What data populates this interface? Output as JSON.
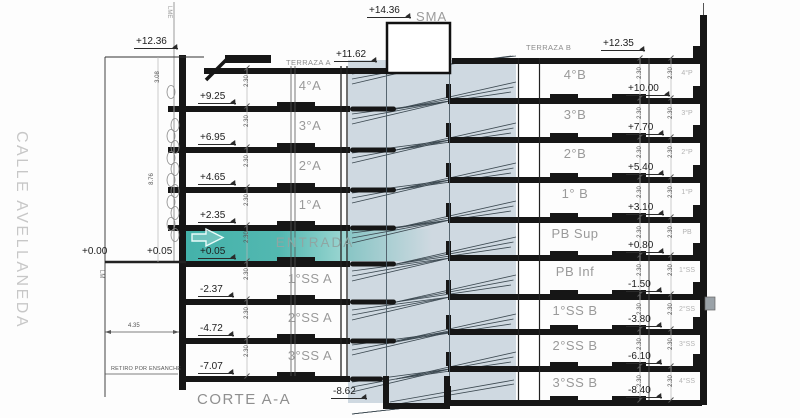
{
  "street": {
    "name": "CALLE AVELLANEDA",
    "property_line": "LM",
    "edification_line": "LME",
    "setback_note": "RETIRO POR ENSANCHE",
    "setback_dim": "4.35",
    "street_level": "+0.00",
    "sidewalk_level": "+0.05"
  },
  "title": "CORTE A-A",
  "roof": {
    "machine_room": "SMA",
    "machine_room_level": "+14.36",
    "parapet_level": "+12.36",
    "terrace_a": "TERRAZA A",
    "terrace_a_level": "+11.62",
    "terrace_b": "TERRAZA B",
    "terrace_b_level": "+12.35"
  },
  "pit_level": "-8.62",
  "dims": {
    "floor_height": "2.30",
    "top_height": "3.08",
    "left_height": "8.76"
  },
  "floors_left": [
    {
      "label": "4°A",
      "level": "+9.25"
    },
    {
      "label": "3°A",
      "level": "+6.95"
    },
    {
      "label": "2°A",
      "level": "+4.65"
    },
    {
      "label": "1°A",
      "level": "+2.35"
    },
    {
      "label": "ENTRADA",
      "level": "+0.05"
    },
    {
      "label": "1°SS A",
      "level": "-2.37"
    },
    {
      "label": "2°SS A",
      "level": "-4.72"
    },
    {
      "label": "3°SS A",
      "level": "-7.07"
    }
  ],
  "floors_right": [
    {
      "label": "4°B",
      "level": "+10.00"
    },
    {
      "label": "3°B",
      "level": "+7.70"
    },
    {
      "label": "2°B",
      "level": "+5.40"
    },
    {
      "label": "1° B",
      "level": "+3.10"
    },
    {
      "label": "PB Sup",
      "level": "+0.80"
    },
    {
      "label": "PB Inf",
      "level": "-1.50"
    },
    {
      "label": "1°SS B",
      "level": "-3.80"
    },
    {
      "label": "2°SS B",
      "level": "-6.10"
    },
    {
      "label": "3°SS B",
      "level": "-8.40"
    }
  ],
  "rear_column": [
    "4°P",
    "3°P",
    "2°P",
    "1°P",
    "PB",
    "1°SS",
    "2°SS",
    "3°SS",
    "4°SS"
  ],
  "colors": {
    "entrance_teal": "#44b2aa",
    "core_shade": "#cfd9e1",
    "slab": "#161616",
    "label_gray": "#9a9a9a"
  }
}
